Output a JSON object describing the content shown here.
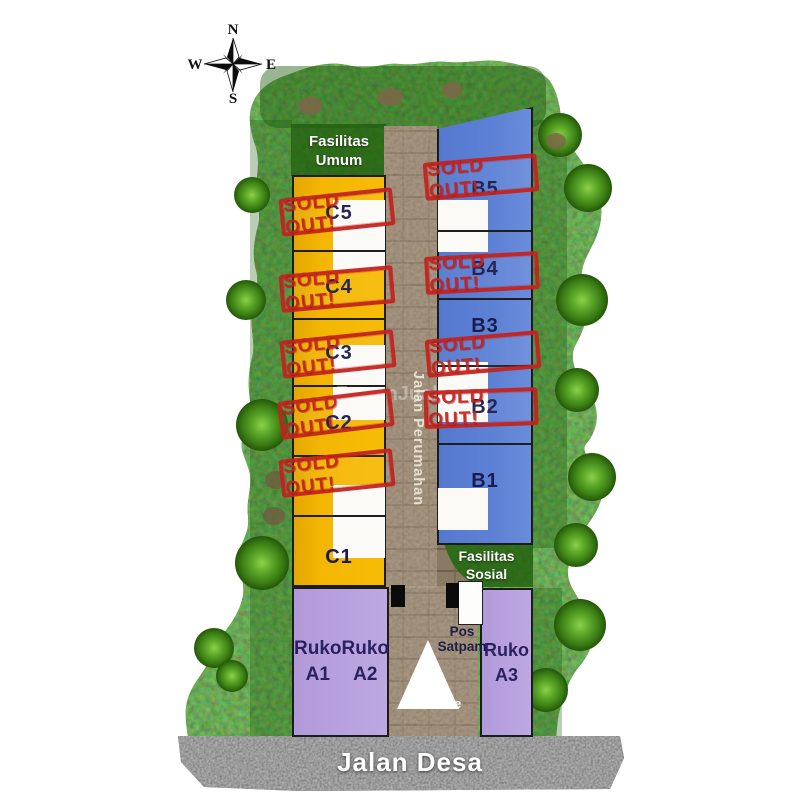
{
  "compass": {
    "north": "N",
    "east": "E",
    "south": "S",
    "west": "W"
  },
  "labels": {
    "sold_out": "SOLD OUT!",
    "fasilitas_umum_line1": "Fasilitas",
    "fasilitas_umum_line2": "Umum",
    "fasilitas_sosial_line1": "Fasilitas",
    "fasilitas_sosial_line2": "Sosial",
    "jalan_perumahan": "Jalan Perumahan",
    "jalan_desa": "Jalan Desa",
    "pos_satpam_line1": "Pos",
    "pos_satpam_line2": "Satpam",
    "entrance": "Entrance",
    "watermark": "ForumJualBeli"
  },
  "blocks": {
    "c": {
      "lots": [
        {
          "id": "C5",
          "sold": true
        },
        {
          "id": "C4",
          "sold": true
        },
        {
          "id": "C3",
          "sold": true
        },
        {
          "id": "C2",
          "sold": true
        },
        {
          "id": "C1",
          "sold": false
        }
      ]
    },
    "b": {
      "lots": [
        {
          "id": "B5",
          "sold": true
        },
        {
          "id": "B4",
          "sold": true
        },
        {
          "id": "B3",
          "sold": true
        },
        {
          "id": "B2",
          "sold": true
        },
        {
          "id": "B1",
          "sold": false
        }
      ]
    },
    "ruko": [
      {
        "line1": "Ruko",
        "line2": "A1"
      },
      {
        "line1": "Ruko",
        "line2": "A2"
      },
      {
        "line1": "Ruko",
        "line2": "A3"
      }
    ]
  },
  "colors": {
    "lot_yellow": "#F2B301",
    "lot_blue": "#5A7ED2",
    "ruko_purple": "#BBA5E0",
    "unit_white": "#FBFAF7",
    "stamp_red": "#C3231F",
    "label_navy": "#1B1B4E",
    "road_brick": "#8A7963",
    "road_asphalt": "#565656",
    "grass_green": "#3A7A14"
  }
}
